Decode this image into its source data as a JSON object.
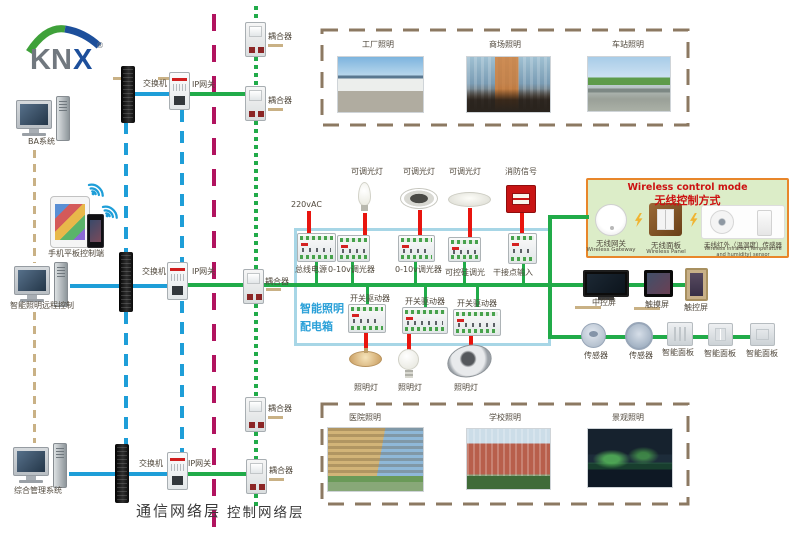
{
  "logo": {
    "kn": "KN",
    "x": "X",
    "reg": "®"
  },
  "colors": {
    "lan_line": "#1e9ed8",
    "knx_bus_line": "#21ab49",
    "power_line": "#e8150f",
    "layer_divider": "#b1135f",
    "link_dash": "#c9b185",
    "panel_box_border": "#a7d6e6",
    "panel_box_title": "#2aa0d8",
    "wireless_box_bg": "#dcedc8",
    "wireless_box_border": "#e8862a",
    "wireless_title": "#cc1212",
    "building_box_dash": "#8c7962"
  },
  "left": {
    "computers": [
      {
        "label": "BA系统"
      },
      {
        "label": "智能照明远程控制"
      },
      {
        "label": "综合管理系统"
      }
    ],
    "mobile_label": "手机平板控制端"
  },
  "network": {
    "switch_labels": [
      "交换机",
      "交换机",
      "交换机"
    ],
    "gateway_labels": [
      "IP网关",
      "IP网关",
      "IP网关"
    ],
    "coupler_labels": [
      "耦合器",
      "耦合器",
      "耦合器",
      "耦合器",
      "耦合器"
    ],
    "layer_labels": {
      "communication": "通信网络层",
      "control": "控制网络层"
    }
  },
  "top_buildings": [
    {
      "label": "工厂照明"
    },
    {
      "label": "商场照明"
    },
    {
      "label": "车站照明"
    }
  ],
  "bottom_buildings": [
    {
      "label": "医院照明"
    },
    {
      "label": "学校照明"
    },
    {
      "label": "景观照明"
    }
  ],
  "panel_box": {
    "title_line1": "智能照明",
    "title_line2": "配电箱",
    "power_label": "220vAC",
    "row1_modules": [
      "总线电源",
      "0-10v调光器",
      "0-10v调光器",
      "可控硅调光",
      "干接点输入"
    ],
    "row1_loads": [
      "可调光灯",
      "可调光灯",
      "可调光灯",
      "消防信号"
    ],
    "row2_modules": [
      "开关驱动器",
      "开关驱动器",
      "开关驱动器"
    ],
    "row2_loads": [
      "照明灯",
      "照明灯",
      "照明灯"
    ]
  },
  "wireless": {
    "title_en": "Wireless control mode",
    "title_zh": "无线控制方式",
    "devices": [
      {
        "zh": "无线网关",
        "en": "Wireless Gateway"
      },
      {
        "zh": "无线面板",
        "en": "Wireless Panel"
      },
      {
        "zh": "无线红外（温湿度）传感器",
        "en": "Wireless infrared (Temperature and humidity) sensor"
      }
    ]
  },
  "right_devices": {
    "screens": [
      "中控屏",
      "触摸屏",
      "触控屏"
    ],
    "sensors": [
      "传感器",
      "传感器"
    ],
    "panels": [
      "智能面板",
      "智能面板",
      "智能面板"
    ]
  }
}
